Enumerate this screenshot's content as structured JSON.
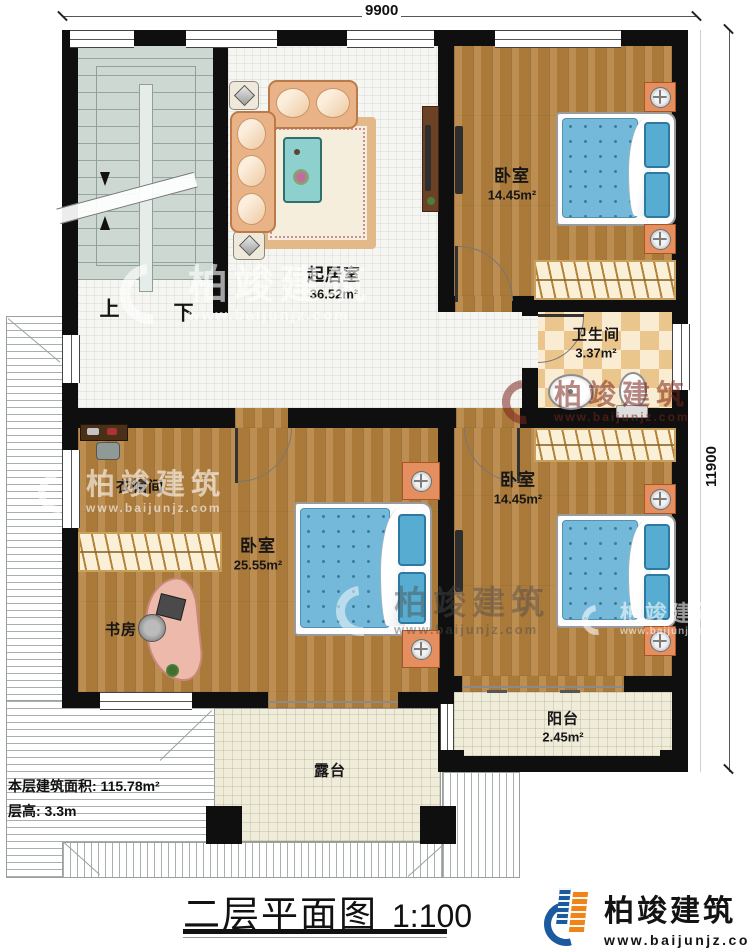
{
  "title": {
    "text": "二层平面图",
    "scale": "1:100"
  },
  "logo": {
    "brand": "柏竣建筑",
    "url": "www.baijunjz.com"
  },
  "watermark": {
    "brand": "柏竣建筑",
    "url": "www.baijunjz.com"
  },
  "dimensions": {
    "width": "9900",
    "height": "11900"
  },
  "info": {
    "line1": "本层建筑面积: 115.78m²",
    "line2": "层高: 3.3m"
  },
  "stairs": {
    "up": "上",
    "down": "下"
  },
  "rooms": {
    "living": {
      "name": "起居室",
      "area": "36.52m²"
    },
    "bedroom_top": {
      "name": "卧室",
      "area": "14.45m²"
    },
    "bathroom": {
      "name": "卫生间",
      "area": "3.37m²"
    },
    "bedroom_right": {
      "name": "卧室",
      "area": "14.45m²"
    },
    "bedroom_master": {
      "name": "卧室",
      "area": "25.55m²"
    },
    "cloakroom": {
      "name": "衣帽间"
    },
    "study": {
      "name": "书房"
    },
    "balcony": {
      "name": "阳台",
      "area": "2.45m²"
    },
    "terrace": {
      "name": "露台"
    }
  }
}
